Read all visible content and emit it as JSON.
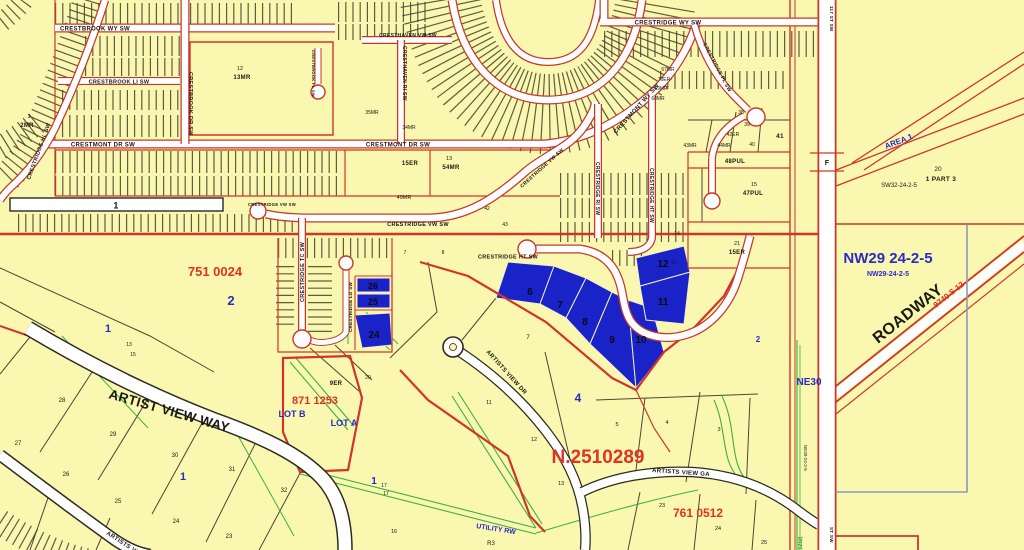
{
  "colors": {
    "background": "#FAF7B0",
    "road_fill": "#FFFFFF",
    "road_casing_red": "#C8372D",
    "road_casing_dark": "#2E2B20",
    "parcel_line": "#4A4732",
    "red_line": "#D2342A",
    "green_line": "#3BB143",
    "gray_blue_line": "#8E9AB8",
    "highlight_fill": "#1A23C8",
    "blue_text": "#2B2BC4",
    "red_text": "#E03224",
    "black_text": "#1A1A12"
  },
  "streets": {
    "crestbrook_wy_sw": "CRESTBROOK WY SW",
    "crestbrook_li_sw": "CRESTBROOK LI SW",
    "crestmont_dr_sw_left": "CRESTMONT DR SW",
    "crestmont_dr_sw_mid": "CRESTMONT DR SW",
    "crestbrook_dr_sw": "CRESTBROOK DR SW",
    "crestbrook_pl_sw": "CRESTBROOK PL SW",
    "cresthaven_vw_sw": "CRESTHAVEN VW SW",
    "cresthaven_ri_sw": "CRESTHAVEN RI SW",
    "crestridge_wy_sw": "CRESTRIDGE WY SW",
    "crestridge_pl_sw": "CRESTRIDGE PL SW",
    "crestmont_wy_sw": "CRESTMONT WY SW",
    "crestridge_vw_sw_main": "CRESTRIDGE VW SW",
    "crestridge_vw_sw_diag": "CRESTRIDGE VW SW",
    "crestridge_vw_sw_bulb": "CRESTRIDGE VW SW",
    "crestridge_tc_sw": "CRESTRIDGE TC SW",
    "crestridge_ld_sw": "CRESTRIDGE LD SW",
    "crestridge_hl_sw": "CRESTRIDGE HL SW",
    "crestridge_ri_sw": "CRESTRIDGE RI SW",
    "crestridge_ht_sw_vert": "CRESTRIDGE HT SW",
    "crestridge_ht_sw_bulb": "CRESTRIDGE HT SW",
    "st_117_sw_top": "117 ST SW",
    "st_sw_bottom": "ST SW",
    "artist_view_way": "ARTIST VIEW WAY",
    "artists_view_dr": "ARTISTS VIEW DR",
    "artists_view_ga": "ARTISTS VIEW GA",
    "artists_view_wy": "ARTISTS VIEW WY",
    "utility_rw": "UTILITY RW"
  },
  "plans": {
    "plan_751_0024": "751 0024",
    "plan_871_1253": "871 1253",
    "plan_761_0512": "761 0512",
    "plan_n_2510289": "N.2510289",
    "roadway_label": "ROADWAY",
    "roadway_plan": "9740 S 12"
  },
  "sections": {
    "nw29_large": "NW29 24-2-5",
    "nw29_small": "NW29-24-2-5",
    "sw32": "SW32-24-2-5",
    "ne30": "NE30",
    "ne30_vertical": "NE30-24-2-5",
    "area_1": "AREA 1",
    "part_20": "20",
    "part_1_3": "1 PART 3",
    "road_f": "F",
    "green_1212": "(1212)",
    "zone_r3": "R3",
    "lot_b": "LOT B",
    "lot_a": "LOT A",
    "road_lot_1": "1"
  },
  "highlighted_lots": {
    "lot6": "6",
    "lot7": "7",
    "lot8": "8",
    "lot9": "9",
    "lot10": "10",
    "lot11": "11",
    "lot12": "12",
    "lot24": "24",
    "lot25": "25",
    "lot26": "26"
  },
  "blocks": {
    "block_2_left": "2",
    "block_1_left": "1",
    "block_1_bottom": "1",
    "block_1_mid": "1",
    "block_4": "4",
    "block_2_small": "2"
  },
  "reserves": {
    "mr_2_num": "3",
    "mr_2": "2MR",
    "mr_13_num": "12",
    "mr_13": "13MR",
    "mr_54_num": "13",
    "mr_54": "54MR",
    "er_15_left": "15ER",
    "mr_34": "34MR",
    "mr_35": "35MR",
    "mr_49": "49MR",
    "mr_67": "67MR",
    "er_70": "70ER",
    "mr_69": "69MR",
    "mr_68": "68MR",
    "mr_43": "43MR",
    "er_42": "42ER",
    "mr_44": "44MR",
    "pul_48": "48PUL",
    "pul_47_num": "15",
    "pul_47": "47PUL",
    "er_15_right_num": "21",
    "er_15_right": "15ER",
    "er_9_num": "20",
    "er_9": "9ER"
  },
  "lot_numbers": {
    "n41": "41",
    "n40": "40",
    "n39": "39",
    "n38": "38",
    "n42": "42",
    "n43": "43",
    "n14": "14",
    "n21": "21",
    "n7a": "7",
    "n8a": "8",
    "n7b": "7",
    "n11": "11",
    "n28": "28",
    "n29": "29",
    "n30": "30",
    "n31": "31",
    "n32": "32",
    "n27": "27",
    "n26": "26",
    "n25": "25",
    "n24": "24",
    "n23": "23",
    "n13a": "13",
    "n15a": "15",
    "n17a": "17",
    "n17b": "17",
    "n16": "16",
    "n12a": "12",
    "n13b": "13",
    "n5": "5",
    "n4": "4",
    "n3": "3",
    "n23b": "23",
    "n24b": "24",
    "n25b": "25"
  }
}
